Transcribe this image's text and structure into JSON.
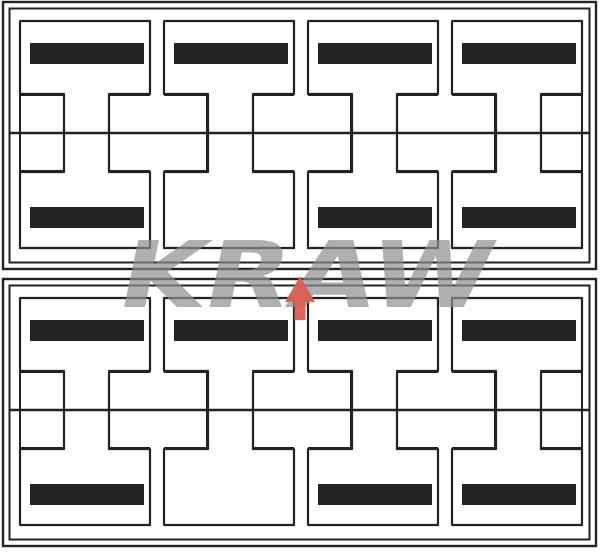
{
  "figure": {
    "title": "I-beam pieces nesting layout, two sheets",
    "watermark": {
      "text": "KRAW",
      "color": "#8f8f8f",
      "arrow_color": "#dd5d52"
    },
    "colors": {
      "background": "#ffffff",
      "line": "#222222",
      "bar_fill": "#242424"
    },
    "panels": [
      {
        "name": "sheet-1",
        "columns": 4,
        "bars": {
          "top": [
            true,
            true,
            true,
            true
          ],
          "bottom": [
            true,
            false,
            true,
            true
          ]
        }
      },
      {
        "name": "sheet-2",
        "columns": 4,
        "bars": {
          "top": [
            true,
            true,
            true,
            true
          ],
          "bottom": [
            true,
            false,
            true,
            true
          ]
        }
      }
    ]
  }
}
